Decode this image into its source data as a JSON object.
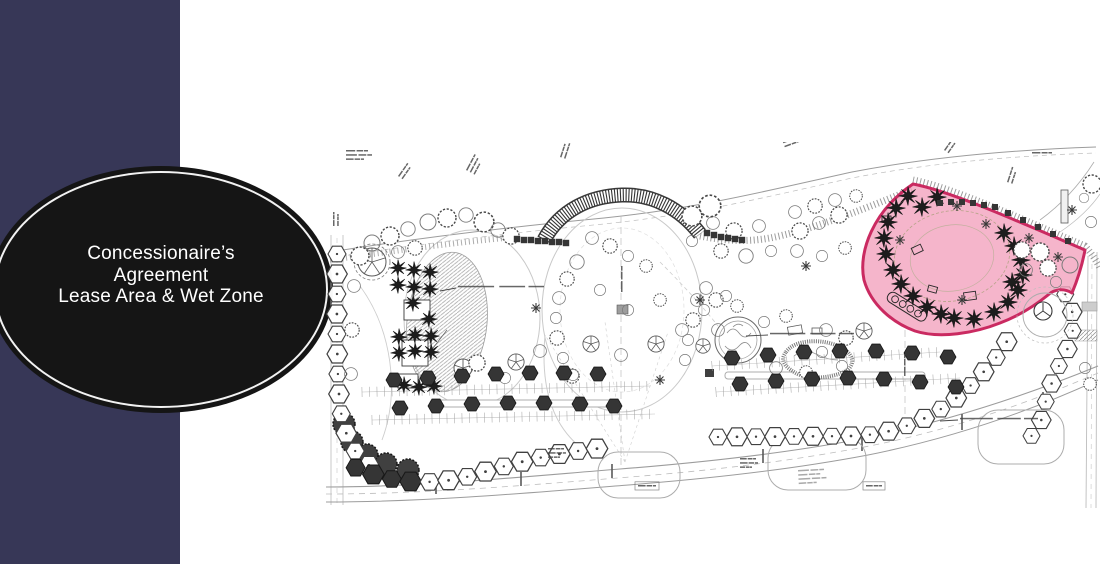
{
  "slide": {
    "type": "presentation-slide",
    "background_color": "#ffffff",
    "accent_bar_color": "#373757",
    "title": {
      "lines": [
        "Concessionaire’s",
        "Agreement",
        "Lease Area & Wet Zone"
      ],
      "text_color": "#ffffff",
      "ellipse_fill": "#151515",
      "ellipse_ring_color": "#f2f2f2"
    }
  },
  "plan": {
    "description": "Scanned landscape-architecture site plan of a park: curving walkways, two oval lawns, tree plantings, a striped arched shade canopy, parking rows, pond and splash-pool water features, and a promenade; micro-scale plan annotations are illegible at this resolution.",
    "highlight": {
      "label": "Lease Area & Wet Zone",
      "fill_color": "#f2a0bc",
      "border_color": "#c9245c"
    },
    "annotations_note": "numerous tiny engineering labels, illegible at source resolution"
  }
}
